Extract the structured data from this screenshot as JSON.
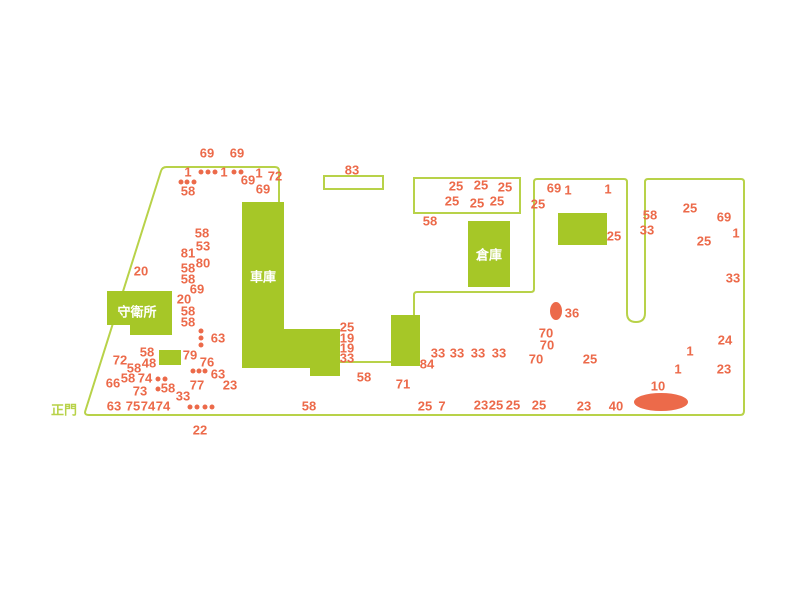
{
  "colors": {
    "building_green": "#a6c727",
    "line_green": "#b8d249",
    "marker_orange": "#ec6a4a",
    "label_white": "#ffffff",
    "background": "#ffffff"
  },
  "map": {
    "gate": {
      "label": "正門",
      "x": 64,
      "y": 410
    },
    "boundary_paths": [
      "M 414 316 L 414 295 Q 414 292 417 292 L 531 292 Q 534 292 534 289 L 534 182 Q 534 179 537 179 L 624 179 Q 627 179 627 182 L 627 313 Q 627 322 636 322 Q 645 322 645 313 L 645 182 Q 645 179 648 179 L 741 179 Q 744 179 744 182 L 744 411 Q 744 415 740 415 L 89 415 Q 84 415 85.3 411 L 161 171 Q 162.3 167 166.5 167 L 275 167 Q 279 167 279 171 L 279 202"
    ],
    "connector_lines": [
      {
        "x1": 340,
        "y1": 362,
        "x2": 391,
        "y2": 362
      }
    ],
    "buildings": [
      {
        "id": "guard-station-building",
        "shape": "polygon",
        "points": "107,291 172,291 172,335 130,335 130,325 107,325",
        "label": "守衛所",
        "label_x": 137,
        "label_y": 312
      },
      {
        "id": "garage-building",
        "shape": "polygon",
        "points": "242,202 284,202 284,329 340,329 340,376 310,376 310,368 242,368",
        "label": "車庫",
        "label_x": 263,
        "label_y": 277
      },
      {
        "id": "warehouse-building",
        "shape": "rect",
        "x": 468,
        "y": 221,
        "w": 42,
        "h": 66,
        "label": "倉庫",
        "label_x": 489,
        "label_y": 255
      },
      {
        "id": "northeast-building",
        "shape": "rect",
        "x": 558,
        "y": 213,
        "w": 49,
        "h": 32
      },
      {
        "id": "mid-building",
        "shape": "rect",
        "x": 391,
        "y": 315,
        "w": 29,
        "h": 51
      },
      {
        "id": "small-square-building",
        "shape": "rect",
        "x": 159,
        "y": 350,
        "w": 22,
        "h": 15
      }
    ],
    "outlined_buildings": [
      {
        "id": "outlined-building-83",
        "x": 324,
        "y": 176,
        "w": 59,
        "h": 13
      },
      {
        "id": "outlined-building-25-block",
        "x": 414,
        "y": 178,
        "w": 106,
        "h": 35
      }
    ],
    "ellipses": [
      {
        "id": "area-ellipse-36",
        "cx": 556,
        "cy": 311,
        "rx": 6,
        "ry": 9
      },
      {
        "id": "area-ellipse-10",
        "cx": 661,
        "cy": 402,
        "rx": 27,
        "ry": 9
      }
    ],
    "dots": [
      [
        201,
        172
      ],
      [
        208,
        172
      ],
      [
        215,
        172
      ],
      [
        234,
        172
      ],
      [
        241,
        172
      ],
      [
        181,
        182
      ],
      [
        187,
        182
      ],
      [
        194,
        182
      ],
      [
        201,
        331
      ],
      [
        201,
        338
      ],
      [
        201,
        345
      ],
      [
        193,
        371
      ],
      [
        199,
        371
      ],
      [
        205,
        371
      ],
      [
        158,
        379
      ],
      [
        165,
        379
      ],
      [
        158,
        389
      ],
      [
        190,
        407
      ],
      [
        197,
        407
      ],
      [
        205,
        407
      ],
      [
        212,
        407
      ]
    ],
    "markers": [
      {
        "v": "69",
        "x": 207,
        "y": 153
      },
      {
        "v": "69",
        "x": 237,
        "y": 153
      },
      {
        "v": "1",
        "x": 188,
        "y": 172
      },
      {
        "v": "1",
        "x": 224,
        "y": 172
      },
      {
        "v": "1",
        "x": 259,
        "y": 173
      },
      {
        "v": "72",
        "x": 275,
        "y": 176
      },
      {
        "v": "69",
        "x": 248,
        "y": 180
      },
      {
        "v": "69",
        "x": 263,
        "y": 189
      },
      {
        "v": "58",
        "x": 188,
        "y": 191
      },
      {
        "v": "83",
        "x": 352,
        "y": 170
      },
      {
        "v": "25",
        "x": 456,
        "y": 186
      },
      {
        "v": "25",
        "x": 481,
        "y": 185
      },
      {
        "v": "25",
        "x": 505,
        "y": 187
      },
      {
        "v": "25",
        "x": 452,
        "y": 201
      },
      {
        "v": "25",
        "x": 477,
        "y": 203
      },
      {
        "v": "25",
        "x": 497,
        "y": 201
      },
      {
        "v": "58",
        "x": 430,
        "y": 221
      },
      {
        "v": "69",
        "x": 554,
        "y": 188
      },
      {
        "v": "1",
        "x": 568,
        "y": 190
      },
      {
        "v": "1",
        "x": 608,
        "y": 189
      },
      {
        "v": "25",
        "x": 538,
        "y": 204
      },
      {
        "v": "25",
        "x": 614,
        "y": 236
      },
      {
        "v": "58",
        "x": 650,
        "y": 215
      },
      {
        "v": "33",
        "x": 647,
        "y": 230
      },
      {
        "v": "25",
        "x": 690,
        "y": 208
      },
      {
        "v": "69",
        "x": 724,
        "y": 217
      },
      {
        "v": "1",
        "x": 736,
        "y": 233
      },
      {
        "v": "25",
        "x": 704,
        "y": 241
      },
      {
        "v": "33",
        "x": 733,
        "y": 278
      },
      {
        "v": "58",
        "x": 202,
        "y": 233
      },
      {
        "v": "53",
        "x": 203,
        "y": 246
      },
      {
        "v": "81",
        "x": 188,
        "y": 253
      },
      {
        "v": "80",
        "x": 203,
        "y": 263
      },
      {
        "v": "58",
        "x": 188,
        "y": 268
      },
      {
        "v": "58",
        "x": 188,
        "y": 279
      },
      {
        "v": "69",
        "x": 197,
        "y": 289
      },
      {
        "v": "20",
        "x": 184,
        "y": 299
      },
      {
        "v": "58",
        "x": 188,
        "y": 311
      },
      {
        "v": "58",
        "x": 188,
        "y": 322
      },
      {
        "v": "20",
        "x": 141,
        "y": 271
      },
      {
        "v": "63",
        "x": 218,
        "y": 338
      },
      {
        "v": "58",
        "x": 147,
        "y": 352
      },
      {
        "v": "72",
        "x": 120,
        "y": 360
      },
      {
        "v": "48",
        "x": 149,
        "y": 363
      },
      {
        "v": "58",
        "x": 134,
        "y": 368
      },
      {
        "v": "79",
        "x": 190,
        "y": 355
      },
      {
        "v": "76",
        "x": 207,
        "y": 362
      },
      {
        "v": "63",
        "x": 218,
        "y": 374
      },
      {
        "v": "66",
        "x": 113,
        "y": 383
      },
      {
        "v": "58",
        "x": 128,
        "y": 378
      },
      {
        "v": "74",
        "x": 145,
        "y": 378
      },
      {
        "v": "73",
        "x": 140,
        "y": 391
      },
      {
        "v": "58",
        "x": 168,
        "y": 388
      },
      {
        "v": "77",
        "x": 197,
        "y": 385
      },
      {
        "v": "33",
        "x": 183,
        "y": 396
      },
      {
        "v": "23",
        "x": 230,
        "y": 385
      },
      {
        "v": "63",
        "x": 114,
        "y": 406
      },
      {
        "v": "75",
        "x": 133,
        "y": 406
      },
      {
        "v": "74",
        "x": 148,
        "y": 406
      },
      {
        "v": "74",
        "x": 163,
        "y": 406
      },
      {
        "v": "22",
        "x": 200,
        "y": 430
      },
      {
        "v": "58",
        "x": 309,
        "y": 406
      },
      {
        "v": "25",
        "x": 347,
        "y": 327
      },
      {
        "v": "19",
        "x": 347,
        "y": 338
      },
      {
        "v": "19",
        "x": 347,
        "y": 348
      },
      {
        "v": "33",
        "x": 347,
        "y": 358
      },
      {
        "v": "58",
        "x": 364,
        "y": 377
      },
      {
        "v": "84",
        "x": 427,
        "y": 364
      },
      {
        "v": "71",
        "x": 403,
        "y": 384
      },
      {
        "v": "33",
        "x": 438,
        "y": 353
      },
      {
        "v": "33",
        "x": 457,
        "y": 353
      },
      {
        "v": "33",
        "x": 478,
        "y": 353
      },
      {
        "v": "33",
        "x": 499,
        "y": 353
      },
      {
        "v": "25",
        "x": 425,
        "y": 406
      },
      {
        "v": "7",
        "x": 442,
        "y": 406
      },
      {
        "v": "23",
        "x": 481,
        "y": 405
      },
      {
        "v": "25",
        "x": 496,
        "y": 405
      },
      {
        "v": "25",
        "x": 513,
        "y": 405
      },
      {
        "v": "25",
        "x": 539,
        "y": 405
      },
      {
        "v": "23",
        "x": 584,
        "y": 406
      },
      {
        "v": "40",
        "x": 616,
        "y": 406
      },
      {
        "v": "10",
        "x": 658,
        "y": 386
      },
      {
        "v": "70",
        "x": 546,
        "y": 333
      },
      {
        "v": "70",
        "x": 547,
        "y": 345
      },
      {
        "v": "70",
        "x": 536,
        "y": 359
      },
      {
        "v": "25",
        "x": 590,
        "y": 359
      },
      {
        "v": "36",
        "x": 572,
        "y": 313
      },
      {
        "v": "24",
        "x": 725,
        "y": 340
      },
      {
        "v": "23",
        "x": 724,
        "y": 369
      },
      {
        "v": "1",
        "x": 690,
        "y": 351
      },
      {
        "v": "1",
        "x": 678,
        "y": 369
      }
    ]
  }
}
